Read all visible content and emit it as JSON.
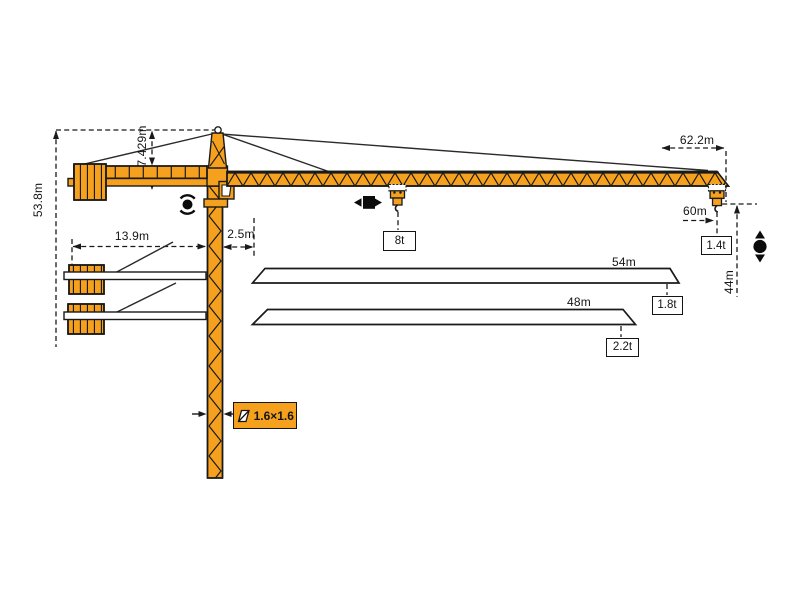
{
  "title": "tower-crane-dimension-diagram",
  "colors": {
    "crane_orange": "#F6A11E",
    "line_black": "#1A1A1A",
    "background": "#FFFFFF"
  },
  "labels": {
    "total_height": "53.8m",
    "apex_height": "7.429m",
    "counterjib_radius": "13.9m",
    "tower_offset": "2.5m",
    "max_radius": "62.2m",
    "hook_radius": "60m",
    "hook_height": "44m",
    "max_capacity": "8t",
    "tip_capacity_max_jib": "1.4t",
    "jib_length_54": "54m",
    "tip_capacity_54": "1.8t",
    "jib_length_48": "48m",
    "tip_capacity_48": "2.2t",
    "mast_section": "1.6×1.6"
  },
  "icons": {
    "slewing": "slewing-rotation-icon",
    "trolley_travel": "trolley-travel-icon",
    "hoist": "hook-hoist-icon",
    "section_symbol": "mast-section-symbol-icon"
  }
}
